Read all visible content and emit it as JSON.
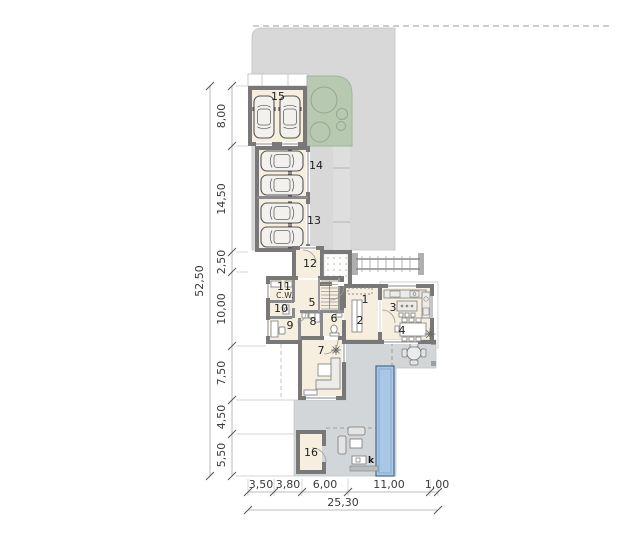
{
  "rooms": {
    "r1": "1",
    "r2": "2",
    "r3": "3",
    "r4": "4",
    "r5": "5",
    "r6": "6",
    "r7": "7",
    "r8": "8",
    "r9": "9",
    "r10": "10",
    "r11": "11",
    "r12": "12",
    "r13": "13",
    "r14": "14",
    "r15": "15",
    "r16": "16"
  },
  "labels": {
    "cw": "C.W.",
    "k": "k"
  },
  "dims": {
    "left": [
      "8,00",
      "14,50",
      "2,50",
      "10,00",
      "7,50",
      "4,50",
      "5,50"
    ],
    "left_total": "52,50",
    "bottom": [
      "3,50",
      "3,80",
      "6,00",
      "11,00",
      "1,00"
    ],
    "bottom_total": "25,30"
  },
  "colors": {
    "paving": "#d8d8d8",
    "paving_band": "#dedede",
    "green": "#b8c9b2",
    "floor": "#f6eede",
    "wall": "#787878",
    "terrace": "#d3d6d8",
    "pool_fill": "#a9c7e6",
    "pool_border": "#46688c",
    "dim_text": "#3a3a3a"
  }
}
